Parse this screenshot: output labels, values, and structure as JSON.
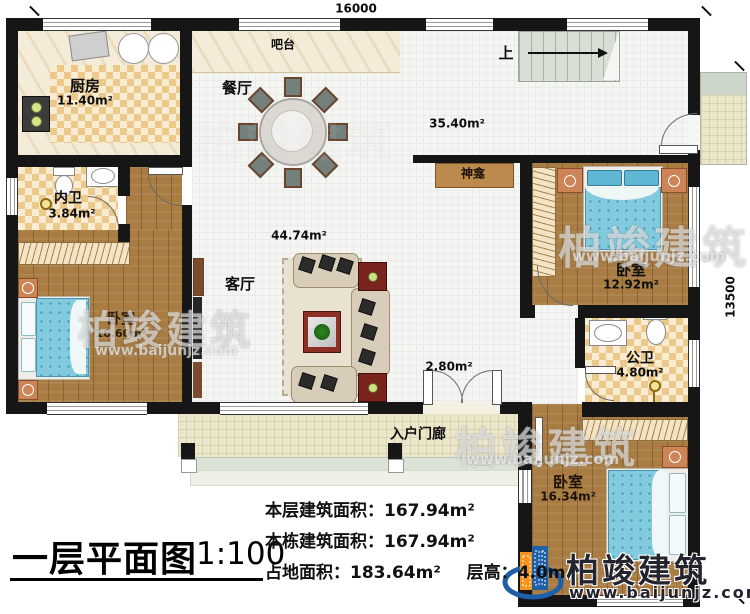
{
  "plan": {
    "dim_width": "16000",
    "dim_height": "13500",
    "rooms": {
      "kitchen": {
        "name": "厨房",
        "area": "11.40m²"
      },
      "bar": {
        "name": "吧台"
      },
      "dining": {
        "name": "餐厅"
      },
      "hall": {
        "area": "35.40m²"
      },
      "stairs": {
        "up": "上"
      },
      "shrine": {
        "name": "神龛"
      },
      "inner_bath": {
        "name": "内卫",
        "area": "3.84m²"
      },
      "bedroom_left": {
        "name": "卧室",
        "area": "16.60m²"
      },
      "living": {
        "name": "客厅",
        "area": "44.74m²"
      },
      "bedroom_right": {
        "name": "卧室",
        "area": "12.92m²"
      },
      "public_bath": {
        "name": "公卫",
        "area": "4.80m²"
      },
      "corridor": {
        "area": "2.80m²"
      },
      "bedroom_bottom": {
        "name": "卧室",
        "area": "16.34m²"
      },
      "porch": {
        "name": "入户门廊"
      }
    }
  },
  "title_block": {
    "title": "一层平面图",
    "scale": "1:100"
  },
  "stats": {
    "line1_label": "本层建筑面积：",
    "line1_value": "167.94m²",
    "line2_label": "本栋建筑面积：",
    "line2_value": "167.94m²",
    "line3_label": "占地面积：",
    "line3_value": "183.64m²",
    "line4_label": "层高：",
    "line4_value": "4.0m"
  },
  "watermark": {
    "brand": "柏竣建筑",
    "url": "www.baijunjz.com"
  },
  "colors": {
    "wall": "#161616",
    "wood": "#a87c42",
    "tile": "#ecc98b",
    "floor": "#f5f6f4",
    "porch": "#ece6cb",
    "bed_blue": "#82cade",
    "logo_blue": "#1e5fa8",
    "logo_orange": "#f7941d"
  }
}
